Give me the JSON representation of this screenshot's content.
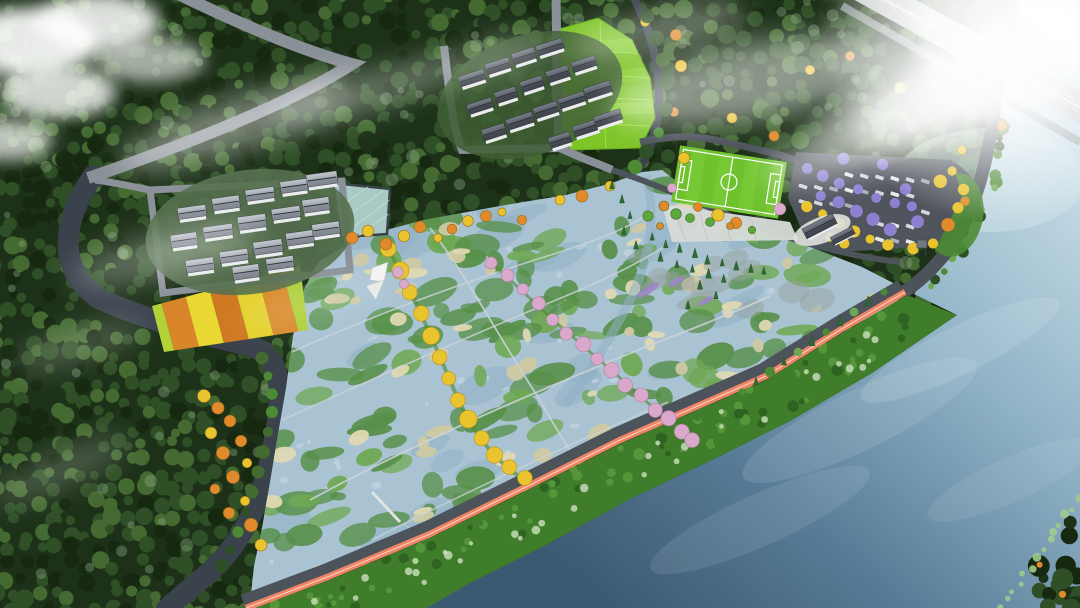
{
  "meta": {
    "title": "Aerial rendering of a riverside wetland park master plan",
    "type": "3D bird's-eye landscape architecture rendering",
    "width_px": 1080,
    "height_px": 608
  },
  "scene": {
    "description": "Bird's-eye rendering of a riverside wetland park: dense misty forest belts, two clusters of gray-roofed courtyard houses, a bright rice paddy, striped flower-crop fields, a square lotus pond, a large marsh wetland crossed by thin walking paths, a ginkgo-lined walk and a cherry-blossom walk, a soccer field with a tree-shaded parking lot and visitor center, a red jogging track on a green levee, and a wide river under clouds and sun glare.",
    "features": [
      {
        "id": "forest-belt",
        "label": "Dense mixed forest with morning mist"
      },
      {
        "id": "north-village",
        "label": "North cluster of gray-roof courtyard houses"
      },
      {
        "id": "west-village",
        "label": "West cluster of gray-roof courtyard houses"
      },
      {
        "id": "rice-paddy",
        "label": "Bright green rice paddy field"
      },
      {
        "id": "crop-strips",
        "label": "Striped orange and yellow flower-crop field"
      },
      {
        "id": "lotus-pond",
        "label": "Square lotus pond"
      },
      {
        "id": "wetland",
        "label": "Constructed wetland with marsh islands, reed patches and thin paths"
      },
      {
        "id": "yellow-tree-walk",
        "label": "Ginkgo-lined curving walk"
      },
      {
        "id": "cherry-tree-walk",
        "label": "Cherry-blossom-lined walk"
      },
      {
        "id": "soccer-field",
        "label": "Soccer field with white markings"
      },
      {
        "id": "parking-lot",
        "label": "Tree-shaded parking lot with parked cars"
      },
      {
        "id": "visitor-center",
        "label": "Visitor-center buildings with dark roofs"
      },
      {
        "id": "riverside-track",
        "label": "Red riverside jogging track on the green levee"
      },
      {
        "id": "river",
        "label": "Wide river along the south-east edge"
      },
      {
        "id": "highway",
        "label": "Expressway crossing the north-east corner"
      },
      {
        "id": "canal",
        "label": "Dark canal winding around the farmland"
      },
      {
        "id": "clouds",
        "label": "White clouds, mist streaks and sun glare"
      }
    ],
    "palette": {
      "forest_dark": "#1d3119",
      "forest_deep": "#16280f",
      "forest_mid": "#2f4f26",
      "forest_light": "#446a31",
      "forest_pale": "#8fae87",
      "grass": "#4c8a34",
      "grass_bright": "#5da73d",
      "canal": "#3a424c",
      "road": "#8a9097",
      "road_dark": "#4d535b",
      "asphalt": "#50555d",
      "wet_water": "#a9c3d3",
      "wet_water_deep": "#8fb0c4",
      "marsh": "#579049",
      "marsh_light": "#6fa854",
      "reed": "#cfc9a2",
      "reed_light": "#ded8b2",
      "mud": "#97a49f",
      "path": "#ccd4d8",
      "river_light": "#c6dce6",
      "river_mid": "#7fa3ba",
      "river_dark": "#3c5972",
      "levee": "#3f7d2a",
      "levee_dark": "#2f6420",
      "levee_light": "#55963a",
      "shrub_pale": "#cfe3c3",
      "track": "#ee8465",
      "track_line": "#fad3c0",
      "paddy": "#7ec528",
      "paddy_light": "#9ade46",
      "paddy_line": "#b4ea5c",
      "pitch": "#6fc12e",
      "pitch_stripe": "#79ca37",
      "white": "#ffffff",
      "wall": "#e9ebed",
      "ridge": "#2b2f36",
      "roof_a1": "#7b818a",
      "roof_a2": "#3f444c",
      "roof_b1": "#c4c9cf",
      "roof_b2": "#7e848d",
      "tree_yellow": "#e9c42f",
      "tree_orange": "#e08a2b",
      "tree_purple": "#8d80d1",
      "tree_pink": "#d9a9cb",
      "flower_purple": "#9c86c8",
      "conifer": "#2e6b34",
      "conifer_dark": "#24552a",
      "pond": "#a9cac4",
      "pond_line": "#c6ddd5",
      "car_a": "#d2d6db",
      "car_b": "#aab0b8",
      "car_c": "#e8eaec",
      "cloud": "#ffffff",
      "farm": [
        "#b2d237",
        "#d9862a",
        "#e8d831",
        "#cf7a22",
        "#e4d12e",
        "#d98a2a",
        "#afcf38"
      ]
    }
  }
}
